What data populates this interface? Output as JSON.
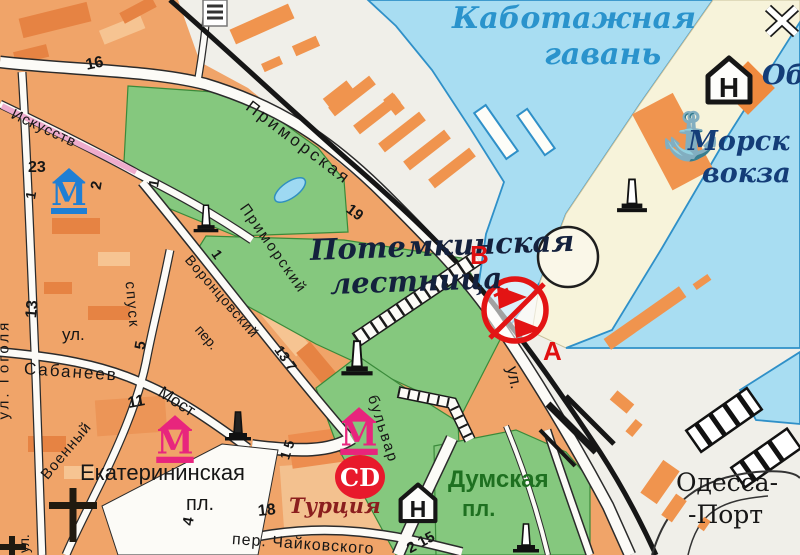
{
  "map_title": "Odessa city map — Potemkin Stairs / port area",
  "colors": {
    "water": "#a8ddf2",
    "shore": "#2f90c8",
    "park": "#85c87e",
    "park_edge": "#3a8a3a",
    "blocks": "#f0a469",
    "blocks_dark": "#e57f3f",
    "blocks_light": "#f7c897",
    "pier_cream": "#f7f3da",
    "port_land": "#f0efe9",
    "street": "#fcfbf7",
    "railway": "#161616",
    "marker_red": "#e01010",
    "sign_red": "#e31414",
    "museum_pink": "#e8257d",
    "museum_blue": "#1f7fd4",
    "hotel_black": "#161616",
    "harbor_text": "#2a93cc",
    "marine_text": "#143d78",
    "name_text": "#14213d",
    "green_text": "#1e7020",
    "maroon_text": "#8b1e1e",
    "cd_red": "#e8192c",
    "pink_street": "#eeaccd",
    "anchor_dark": "#10506e",
    "anchor_light": "#45b4e4"
  },
  "labels": {
    "harbor_line1": "Каботажная",
    "harbor_line2": "гавань",
    "marine_line1": "Морск",
    "marine_line2": "вокза",
    "ob": "Об",
    "potemkin_line1": "Потемкинская",
    "potemkin_line2": "лестница",
    "marker_b": "В",
    "marker_a": "А",
    "primorskaya": "Приморская",
    "ul_port": "ул.",
    "primorsky": "Приморский",
    "bulvar": "бульвар",
    "vorontsovsky": "Воронцовский",
    "vorontsovsky_per": "пер.",
    "iskusstv": "Искусств",
    "gogolya": "ул. Гоголя",
    "ul_sabaneev": "ул.",
    "sabaneev": "Сабанеев",
    "most": "Мост",
    "voenny": "Военный",
    "spusk": "спуск",
    "ul_small": "ул.",
    "ekaterininskaya": "Екатерининская",
    "ekaterininskaya_pl": "пл.",
    "turkey": "Турция",
    "cd": "CD",
    "dumskaya": "Думская",
    "dumskaya_pl": "пл.",
    "odessa_line1": "Одесса-",
    "odessa_line2": "-Порт",
    "chaikovskogo": "пер. Чайковского",
    "hotel": "Н",
    "museum": "М"
  },
  "house_numbers": {
    "n16": "16",
    "n23": "23",
    "n2": "2",
    "n1a": "1",
    "n1b": "1",
    "n1c": "1",
    "n13": "13",
    "n5": "5",
    "n11": "11",
    "n19": "19",
    "n13_7": "13 7",
    "n4": "4",
    "n18": "18",
    "n1_5": "1 5",
    "n2_15": "2 15"
  },
  "icons": {
    "anchor": "⚓"
  }
}
